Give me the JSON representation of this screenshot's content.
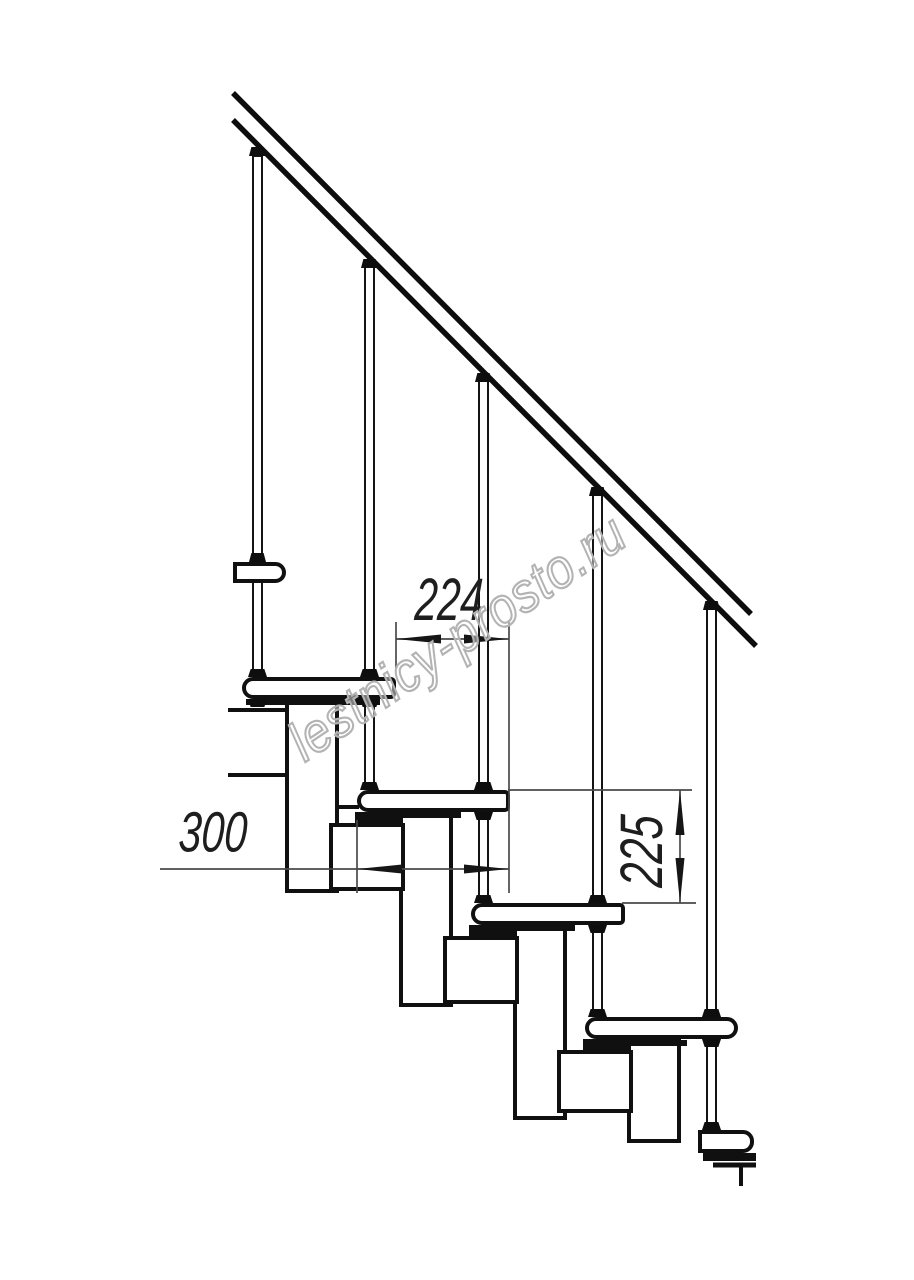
{
  "page": {
    "background": "#ffffff",
    "width": 914,
    "height": 1280
  },
  "drawing": {
    "type": "technical-drawing",
    "subject": "modular staircase side elevation with handrail",
    "units": "mm",
    "line_color": "#101010",
    "dim_line_color": "#4a4a4a",
    "components": {
      "handrail_count": 1,
      "baluster_count": 5,
      "tread_count": 5,
      "spine_module_count": 7
    },
    "dimensions": [
      {
        "name": "step going",
        "value": "224",
        "orientation": "horizontal"
      },
      {
        "name": "tread depth",
        "value": "300",
        "orientation": "horizontal"
      },
      {
        "name": "riser height",
        "value": "225",
        "orientation": "vertical"
      }
    ]
  },
  "watermark": {
    "text": "lestnicy-prosto.ru",
    "color": "#b3b3b3"
  }
}
